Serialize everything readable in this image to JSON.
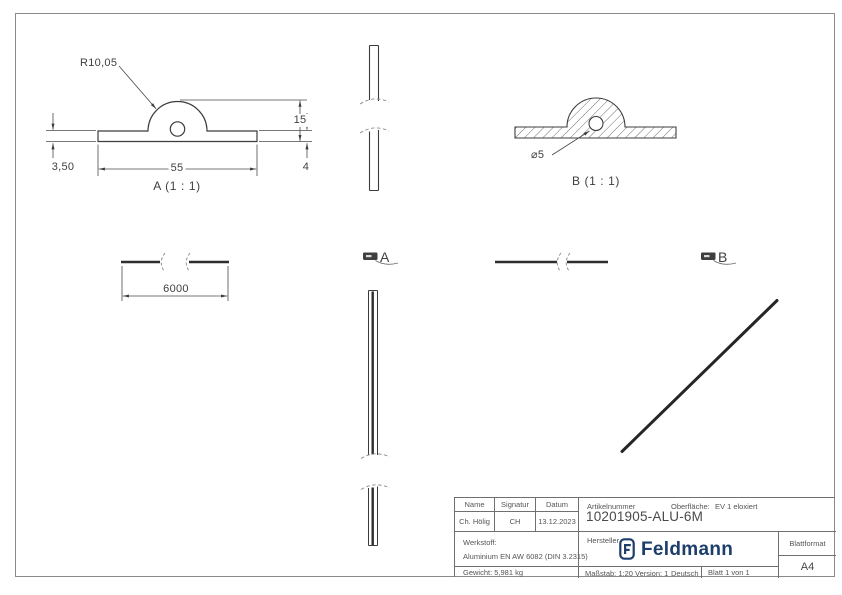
{
  "views": {
    "section_a": {
      "label": "A (1 : 1)",
      "radius": "R10,05",
      "height": "15",
      "width": "55",
      "thickness_left": "3,50",
      "thickness_right": "4"
    },
    "section_b": {
      "label": "B (1 : 1)",
      "hole_dia": "⌀5"
    },
    "length_view": {
      "length": "6000"
    },
    "arrow_a": "A",
    "arrow_b": "B"
  },
  "title_block": {
    "headers": {
      "name": "Name",
      "signatur": "Signatur",
      "datum": "Datum"
    },
    "values": {
      "name": "Ch. Hölig",
      "signatur": "CH",
      "datum": "13.12.2023"
    },
    "werkstoff_label": "Werkstoff:",
    "werkstoff_value": "Aluminium EN AW 6082 (DIN 3.2315)",
    "gewicht": "Gewicht: 5,981 kg",
    "artikelnummer_label": "Artikelnummer",
    "artikelnummer_value": "10201905-ALU-6M",
    "oberflaeche_label": "Oberfläche:",
    "oberflaeche_value": "EV 1 eloxiert",
    "hersteller_label": "Hersteller",
    "brand": "Feldmann",
    "blattformat_label": "Blattformat",
    "blattformat_value": "A4",
    "massstab": "Maßstab: 1:20",
    "version": "Version: 1",
    "sprache": "Deutsch",
    "blatt": "Blatt 1 von 1"
  },
  "colors": {
    "brand_navy": "#1d3e6b",
    "line": "#3c3c3c",
    "frame": "#8a8a8a"
  }
}
